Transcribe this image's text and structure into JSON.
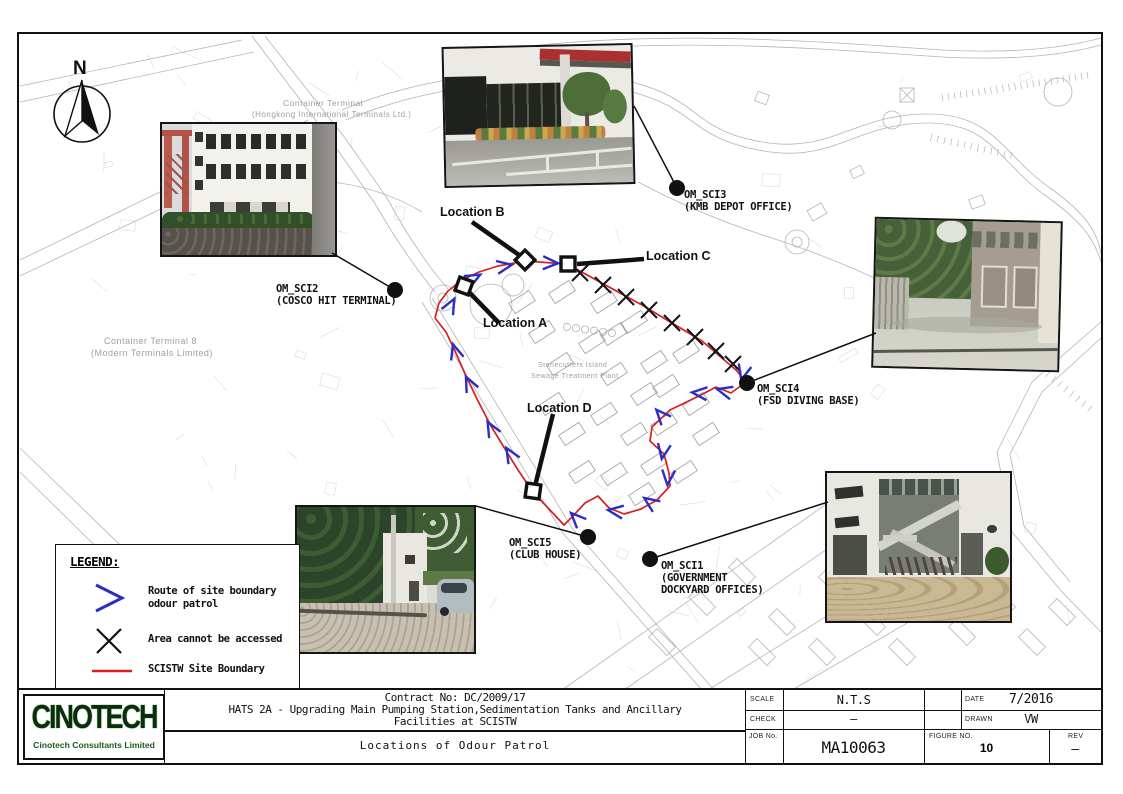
{
  "colors": {
    "route_red": "#d81f1f",
    "arrow_blue": "#2a2ec4",
    "ink_black": "#111111",
    "map_gray": "#b4b4b4",
    "text_gray": "#9f9f9f",
    "logo_green": "#1c5c1c"
  },
  "compass": {
    "label": "N"
  },
  "legend": {
    "title": "LEGEND:",
    "items": [
      {
        "icon": "route-arrow-icon",
        "label": "Route of site boundary\nodour patrol"
      },
      {
        "icon": "x-mark-icon",
        "label": "Area cannot be accessed"
      },
      {
        "icon": "red-line-icon",
        "label": "SCISTW Site Boundary"
      },
      {
        "icon": "dot-icon",
        "label": "Odour monitoring stations"
      }
    ]
  },
  "map_texts": [
    {
      "text": "Container Terminal",
      "x": 283,
      "y": 98,
      "size": 8.5
    },
    {
      "text": "(Hongkong International Terminals Ltd.)",
      "x": 252,
      "y": 110,
      "size": 8
    },
    {
      "text": "Container Terminal 8",
      "x": 104,
      "y": 336,
      "size": 9
    },
    {
      "text": "(Modern Terminals Limited)",
      "x": 91,
      "y": 348,
      "size": 9
    },
    {
      "text": "Stonecutters Island",
      "x": 538,
      "y": 362,
      "size": 7
    },
    {
      "text": "Sewage Treatment Plant",
      "x": 531,
      "y": 373,
      "size": 7
    }
  ],
  "stations": [
    {
      "id": "OM_SCI2",
      "name": "(COSCO HIT TERMINAL)",
      "label_x": 276,
      "label_y": 283,
      "dot_x": 393,
      "dot_y": 288,
      "anchor_x": 330,
      "anchor_y": 251
    },
    {
      "id": "OM_SCI3",
      "name": "(KMB DEPOT OFFICE)",
      "label_x": 684,
      "label_y": 189,
      "dot_x": 675,
      "dot_y": 186,
      "anchor_x": 632,
      "anchor_y": 104
    },
    {
      "id": "OM_SCI4",
      "name": "(FSD DIVING BASE)",
      "label_x": 757,
      "label_y": 383,
      "dot_x": 745,
      "dot_y": 381,
      "anchor_x": 874,
      "anchor_y": 331
    },
    {
      "id": "OM_SCI5",
      "name": "(CLUB HOUSE)",
      "label_x": 509,
      "label_y": 537,
      "dot_x": 586,
      "dot_y": 535,
      "anchor_x": 474,
      "anchor_y": 504
    },
    {
      "id": "OM_SCI1",
      "name": "(GOVERNMENT\nDOCKYARD OFFICES)",
      "label_x": 661,
      "label_y": 560,
      "dot_x": 648,
      "dot_y": 557,
      "anchor_x": 826,
      "anchor_y": 500
    }
  ],
  "locations": [
    {
      "label": "Location A",
      "x": 483,
      "y": 316,
      "mx": 462,
      "my": 284,
      "rot": 20,
      "lx1": 497,
      "ly1": 321,
      "lx2": 465,
      "ly2": 288
    },
    {
      "label": "Location B",
      "x": 440,
      "y": 205,
      "mx": 523,
      "my": 258,
      "rot": 45,
      "lx1": 470,
      "ly1": 220,
      "lx2": 520,
      "ly2": 255
    },
    {
      "label": "Location C",
      "x": 646,
      "y": 249,
      "mx": 566,
      "my": 262,
      "rot": 0,
      "lx1": 642,
      "ly1": 257,
      "lx2": 575,
      "ly2": 262
    },
    {
      "label": "Location D",
      "x": 527,
      "y": 401,
      "mx": 531,
      "my": 489,
      "rot": 8,
      "lx1": 551,
      "ly1": 412,
      "lx2": 533,
      "ly2": 484
    }
  ],
  "title_block": {
    "company": "CINOTECH",
    "company_sub": "Cinotech Consultants Limited",
    "contract_line1": "Contract No: DC/2009/17",
    "contract_line2": "HATS 2A - Upgrading Main Pumping Station,Sedimentation Tanks and Ancillary",
    "contract_line3": "Facilities at SCISTW",
    "drawing_title": "Locations of Odour Patrol",
    "scale_label": "SCALE",
    "scale_value": "N.T.S",
    "date_label": "DATE",
    "date_value": "7/2016",
    "check_label": "CHECK",
    "check_value": "–",
    "drawn_label": "DRAWN",
    "drawn_value": "VW",
    "job_label": "JOB No.",
    "job_value": "MA10063",
    "figure_label": "FIGURE NO.",
    "figure_value": "10",
    "rev_label": "REV",
    "rev_value": "–"
  }
}
